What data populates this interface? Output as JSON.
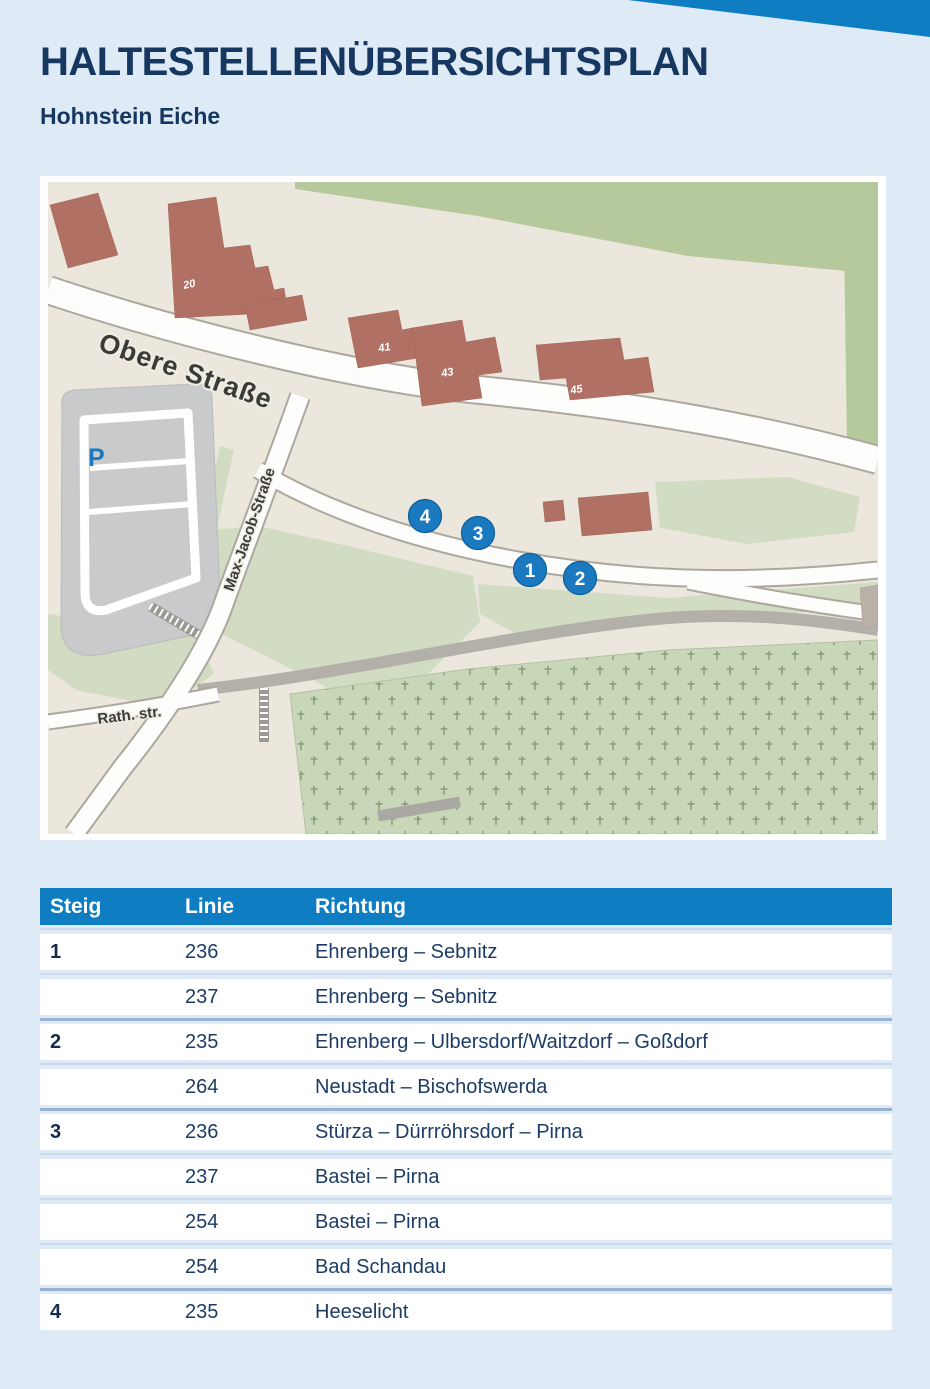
{
  "page": {
    "title": "HALTESTELLENÜBERSICHTSPLAN",
    "subtitle": "Hohnstein Eiche",
    "colors": {
      "background": "#dfeaf7",
      "accent_blue": "#0e7dc2",
      "navy_text": "#16375f",
      "map_ground": "#ebe7dc",
      "map_green_dark": "#b6c99c",
      "map_green_light": "#d1dcc3",
      "map_cemetery": "#c9d7b9",
      "map_building": "#b07164",
      "map_road_white": "#fdfdfc",
      "map_road_gray": "#b3b0aa",
      "map_parking_gray": "#c9cacc",
      "stop_marker_blue": "#1b79c0"
    }
  },
  "map": {
    "street_labels": {
      "obere": "Obere Straße",
      "max_jacob": "Max-Jacob-Straße",
      "rath": "Rath. str."
    },
    "parking_label": "P",
    "building_labels": [
      "20",
      "41",
      "43",
      "45"
    ],
    "stops": [
      {
        "number": "1"
      },
      {
        "number": "2"
      },
      {
        "number": "3"
      },
      {
        "number": "4"
      }
    ]
  },
  "table": {
    "headers": {
      "steig": "Steig",
      "linie": "Linie",
      "richtung": "Richtung"
    },
    "rows": [
      {
        "steig": "1",
        "linie": "236",
        "richtung": "Ehrenberg – Sebnitz"
      },
      {
        "steig": "",
        "linie": "237",
        "richtung": "Ehrenberg – Sebnitz"
      },
      {
        "steig": "2",
        "linie": "235",
        "richtung": "Ehrenberg – Ulbersdorf/Waitzdorf – Goßdorf"
      },
      {
        "steig": "",
        "linie": "264",
        "richtung": "Neustadt – Bischofswerda"
      },
      {
        "steig": "3",
        "linie": "236",
        "richtung": "Stürza – Dürrröhrsdorf – Pirna"
      },
      {
        "steig": "",
        "linie": "237",
        "richtung": "Bastei – Pirna"
      },
      {
        "steig": "",
        "linie": "254",
        "richtung": "Bastei – Pirna"
      },
      {
        "steig": "",
        "linie": "254",
        "richtung": "Bad Schandau"
      },
      {
        "steig": "4",
        "linie": "235",
        "richtung": "Heeselicht"
      }
    ]
  }
}
